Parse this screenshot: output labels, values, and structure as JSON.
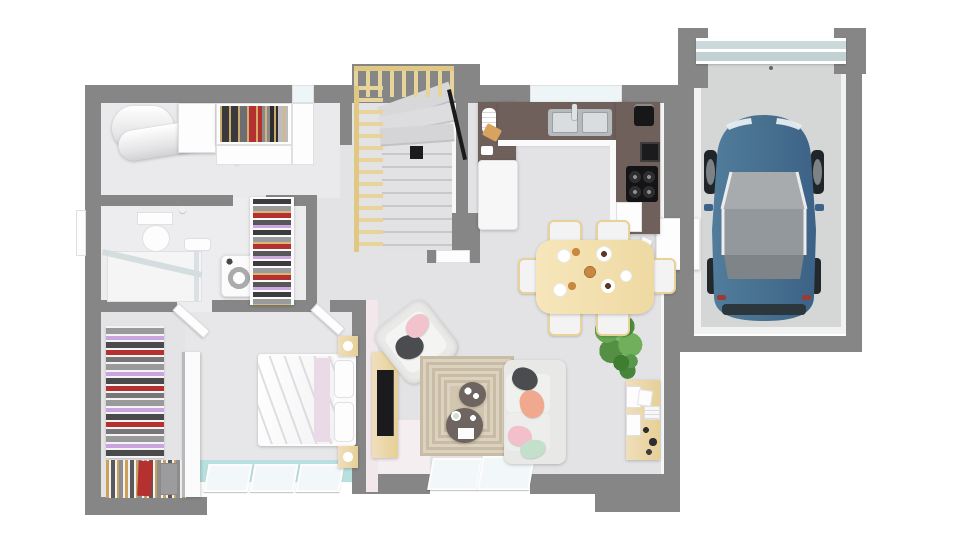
{
  "meta": {
    "image_type": "architectural 3d floor plan rendering",
    "view": "top-down",
    "visible_text": "none",
    "background": "#ffffff"
  },
  "palette": {
    "wall": "#868686",
    "wall_inner_face": "#f8f8f9",
    "floor_main": "#e3e3e5",
    "floor_bathroom": "#ededef",
    "floor_bedroom": "#e7e7e9",
    "floor_garage": "#d5d6d6",
    "hall_accent_pink": "#f4eef0",
    "kitchen_counter_taupe": "#6f605c",
    "light_wood": "#ecd9a4",
    "stair_rail_wood": "#e7d49a",
    "car_body_blue": "#47708f",
    "window_glass_aqua": "#b7e0de",
    "garage_door_panel": "#ccd9da",
    "rug_beige": "#d2c6b0",
    "sofa_gray": "#e2e2e0",
    "tv_black": "#1b1b1e",
    "pillow_dark_gray": "#4a4c4f",
    "pillow_salmon": "#f0a88e",
    "pillow_pink": "#f3c0ca",
    "pillow_mint": "#c2e0cb",
    "plant_green": "#5f9e4b",
    "clothes_red": "#b5312f",
    "clothes_purple": "#c9a4de"
  },
  "rooms": [
    {
      "id": "garage",
      "name": "garage",
      "furniture": [
        "sectional garage door",
        "parked car"
      ]
    },
    {
      "id": "kitchen",
      "name": "kitchen",
      "furniture": [
        "u-shaped taupe counter",
        "double sink with faucet",
        "4-burner cooktop",
        "built-in oven",
        "coffee machine",
        "fridge",
        "dishwasher",
        "dish stack",
        "cutting board"
      ]
    },
    {
      "id": "dining-area",
      "name": "dining area",
      "furniture": [
        "light wood table",
        "six chairs",
        "breakfast plates",
        "croissants",
        "coffee cups"
      ]
    },
    {
      "id": "living-room",
      "name": "living room",
      "furniture": [
        "sofa with pillows",
        "armchair with cushions",
        "patterned rug",
        "two round coffee tables",
        "tv sideboard",
        "flat tv",
        "desk cabinet",
        "large plant",
        "small plant",
        "sliding glass door"
      ]
    },
    {
      "id": "entry-hall",
      "name": "entry hall",
      "furniture": [
        "under-stairs closet with door"
      ]
    },
    {
      "id": "staircase",
      "name": "staircase",
      "furniture": [
        "wood baluster railing",
        "winder steps",
        "straight steps",
        "black newel post",
        "black handrail"
      ]
    },
    {
      "id": "bathroom",
      "name": "bathroom",
      "furniture": [
        "toilet",
        "wall-hung sink",
        "glass shower",
        "washing machine",
        "linen closet with clothes",
        "side window"
      ]
    },
    {
      "id": "laundry-room",
      "name": "utility room",
      "furniture": [
        "water heater cylinders",
        "white cabinets",
        "open wardrobe with hanging clothes"
      ]
    },
    {
      "id": "bedroom",
      "name": "bedroom",
      "furniture": [
        "double bed with white duvet",
        "pink throw",
        "two pillows",
        "two wood nightstands with lamps",
        "triple window with aqua glass"
      ]
    },
    {
      "id": "dressing-room",
      "name": "dressing room",
      "furniture": [
        "shelving with folded clothes",
        "hanging rail with garments",
        "white partition"
      ]
    }
  ],
  "vehicle": {
    "type": "car",
    "color_name": "steel blue",
    "location": "garage",
    "orientation": "front toward garage door"
  }
}
